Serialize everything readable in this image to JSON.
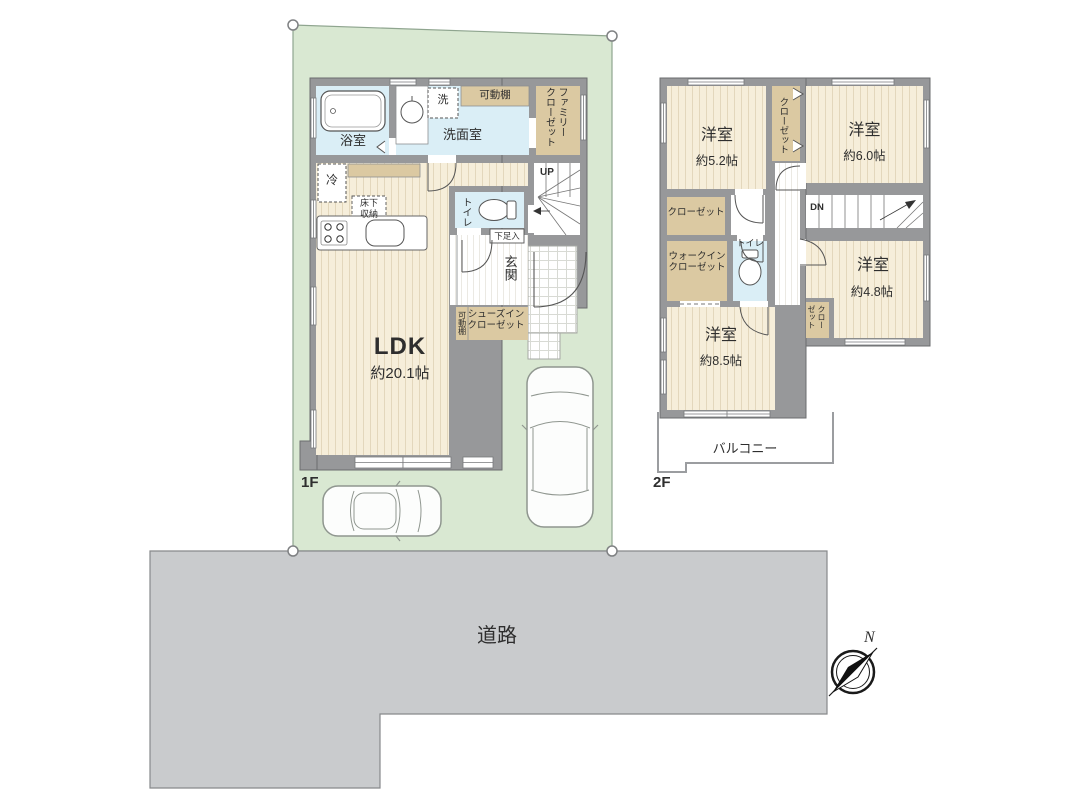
{
  "floor1": {
    "floor_label": "1F",
    "bath": "浴室",
    "washroom": "洗面室",
    "washer": "洗",
    "movable_shelf": "可動棚",
    "family_closet_col1": "ファミリー",
    "family_closet_col2": "クローゼット",
    "fridge": "冷",
    "underfloor_l1": "床下",
    "underfloor_l2": "収納",
    "toilet": "トイレ",
    "stairs_up": "UP",
    "shoe_box": "下足入",
    "entrance": "玄関",
    "sic_shelf": "可動棚",
    "sic_l1": "シューズイン",
    "sic_l2": "クローゼット",
    "ldk": "LDK",
    "ldk_size": "約20.1帖"
  },
  "floor2": {
    "floor_label": "2F",
    "room_a": "洋室",
    "room_a_size": "約5.2帖",
    "closet_a": "クローゼット",
    "room_b": "洋室",
    "room_b_size": "約6.0帖",
    "closet_b": "クローゼット",
    "stairs_down": "DN",
    "wic_l1": "ウォークイン",
    "wic_l2": "クローゼット",
    "toilet": "トイレ",
    "room_c": "洋室",
    "room_c_size": "約4.8帖",
    "closet_c_col1": "クロー",
    "closet_c_col2": "ゼット",
    "room_d": "洋室",
    "room_d_size": "約8.5帖",
    "balcony": "バルコニー"
  },
  "site": {
    "road": "道路",
    "compass_north": "N"
  },
  "colors": {
    "lot_green": "#d9e8d2",
    "road_gray": "#c9cbcd",
    "wall_gray": "#97989a",
    "floor_cream": "#f6eeda",
    "wet_blue": "#daeef6",
    "closet_tan": "#dbc9a2"
  }
}
